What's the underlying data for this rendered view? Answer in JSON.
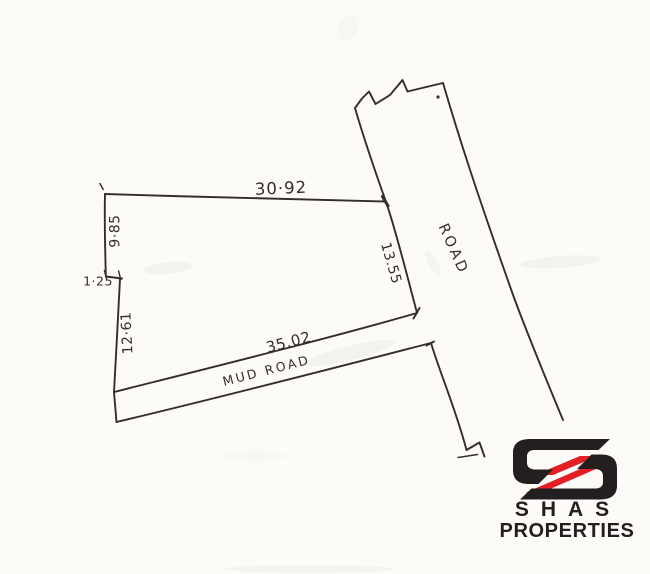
{
  "colors": {
    "paper": "#fcfbf8",
    "ink": "#332e29",
    "logo_black": "#231f20",
    "logo_red": "#e41e25"
  },
  "sketch": {
    "dimensions": {
      "top_edge": "30·92",
      "left_upper_edge": "9·85",
      "left_step": "1·25",
      "left_lower_edge": "12·61",
      "right_edge": "13.55",
      "bottom_edge": "35.02"
    },
    "roads": {
      "main_road_label": "ROAD",
      "mud_road_label": "MUD ROAD"
    }
  },
  "logo": {
    "wordmark": "SHAS",
    "subtitle": "PROPERTIES"
  }
}
